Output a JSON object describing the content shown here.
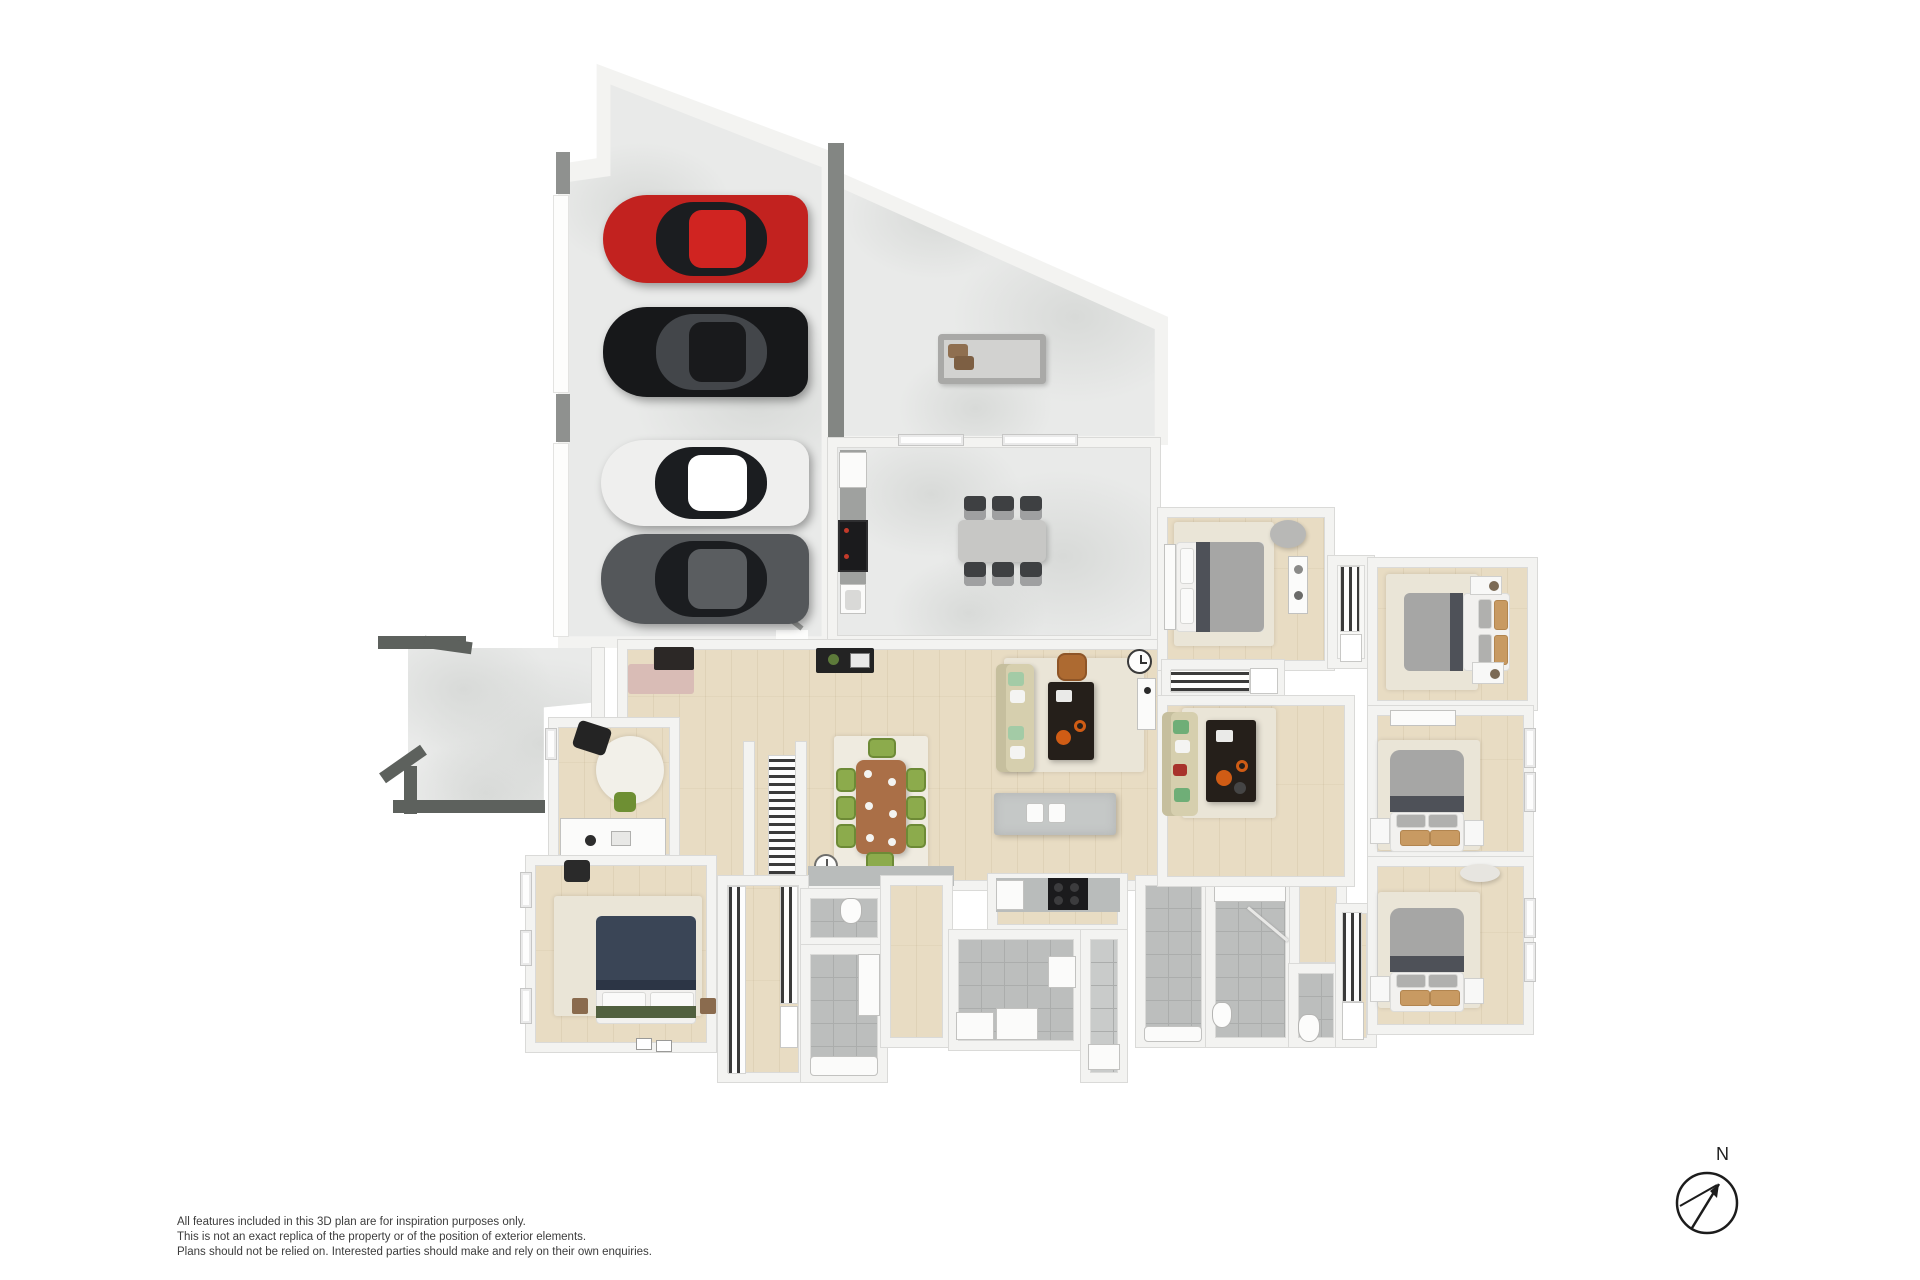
{
  "page": {
    "type": "3d-floor-plan-render",
    "background": "#ffffff"
  },
  "disclaimer": {
    "lines": [
      "All features included in this 3D plan are for inspiration purposes only.",
      "This is not an exact replica of the property or of the position of exterior elements.",
      "Plans should not be relied on. Interested parties should make and rely on their own enquiries."
    ]
  },
  "compass": {
    "label": "N",
    "icon": "compass-north-icon"
  },
  "inventory": {
    "cars": [
      "red",
      "black",
      "white",
      "dark-gray"
    ],
    "bedrooms": 5,
    "bathrooms": 4,
    "outdoor_dining_seats": 6,
    "indoor_dining_seats": 8,
    "living_areas": 2
  },
  "colors": {
    "wall": "#f3f3f1",
    "walledge": "#dadad8",
    "conc": "#e9eae9",
    "conc2": "#d8dad8",
    "wood": "#e8dcc3",
    "tile": "#bcbebd",
    "tileline": "#abadac",
    "darkwall": "#5d615d",
    "rug": "#eae5d7",
    "carred": "#c2221f",
    "carblack": "#17181a",
    "carwhite": "#efefee",
    "cargray": "#54575a",
    "cab": "#1b1d20",
    "cablight": "#43464a",
    "tablewood": "#aa6f47",
    "chgreen": "#8cab4c",
    "chdark": "#3e4042",
    "sofa": "#d6cfae",
    "mint": "#a3cba6",
    "leather": "#ad6a31",
    "coffee": "#251f1a",
    "orange": "#cf5c15",
    "island": "#c5c8c7",
    "counter": "#b9bcbb",
    "appliance": "#1b1b1d",
    "duvet": "#a6a6a5",
    "duvdark": "#4e5158",
    "matt": "#f2f1ef",
    "tan": "#c89a62",
    "navy": "#3a4556",
    "throw": "#51603f",
    "dash": "#3a3a3a",
    "fix": "#fbfbfa",
    "text": "#3c3c3c"
  }
}
